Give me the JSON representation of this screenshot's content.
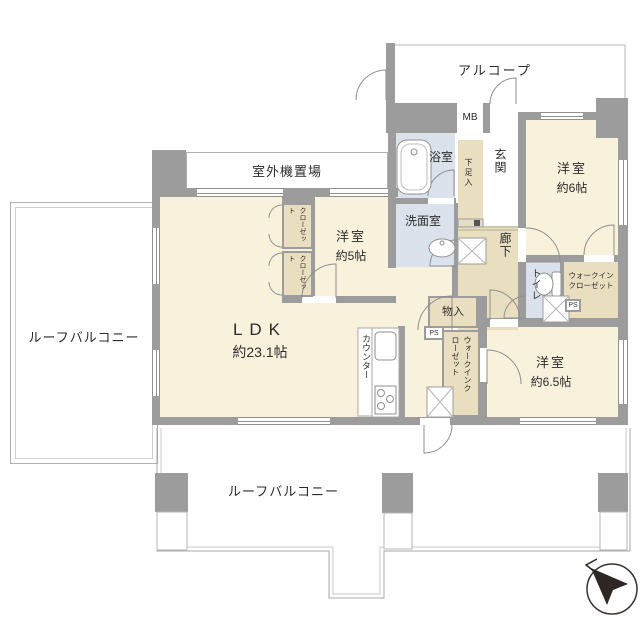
{
  "plan": {
    "type": "apartment-floor-plan",
    "outdoor": {
      "roof_balcony_left": "ルーフバルコニー",
      "roof_balcony_bottom": "ルーフバルコニー",
      "alcove": "アルコープ",
      "outdoor_unit_space": "室外機置場"
    },
    "rooms": {
      "ldk": {
        "name": "LDK",
        "size": "約23.1帖"
      },
      "bedroom_5": {
        "name": "洋室",
        "size": "約5帖"
      },
      "bedroom_6": {
        "name": "洋室",
        "size": "約6帖"
      },
      "bedroom_6_5": {
        "name": "洋室",
        "size": "約6.5帖"
      },
      "bath": "浴室",
      "washroom": "洗面室",
      "entrance": "玄関",
      "hallway": "廊下",
      "toilet": "トイレ"
    },
    "storage": {
      "closet_upper": "クローゼット",
      "closet_lower": "クローゼット",
      "walk_in_closet_ne_line1": "ウォークイン",
      "walk_in_closet_ne_line2": "クローゼット",
      "walk_in_closet_center": "ウォークインクローゼット",
      "storage_small": "物入",
      "shoe_box": "下足入"
    },
    "utility": {
      "meter_box": "MB",
      "pipe_space_1": "PS",
      "pipe_space_2": "PS",
      "kitchen_counter": "カウンター"
    },
    "compass": {
      "direction": "northwest"
    },
    "colors": {
      "wall": "#9c9c9c",
      "room_cream": "#f8f1dc",
      "wet_area_blue": "#dbe2ec",
      "closet_tan": "#e9dfc0",
      "outline": "#b5b5b5"
    }
  }
}
